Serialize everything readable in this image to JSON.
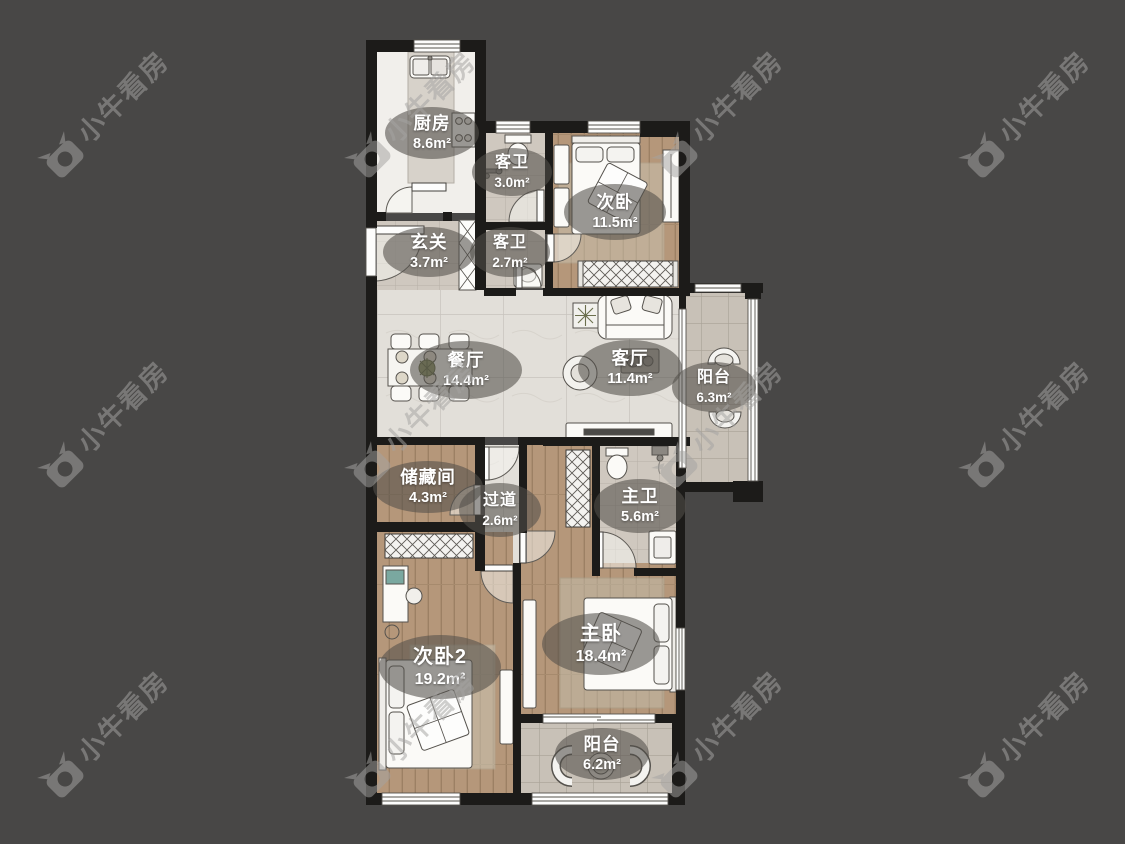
{
  "watermark": {
    "text": "小牛看房"
  },
  "rooms": [
    {
      "id": "kitchen",
      "name": "厨房",
      "area": "8.6m²"
    },
    {
      "id": "guest-bath-top",
      "name": "客卫",
      "area": "3.0m²"
    },
    {
      "id": "bedroom-second",
      "name": "次卧",
      "area": "11.5m²"
    },
    {
      "id": "entry",
      "name": "玄关",
      "area": "3.7m²"
    },
    {
      "id": "guest-bath",
      "name": "客卫",
      "area": "2.7m²"
    },
    {
      "id": "dining",
      "name": "餐厅",
      "area": "14.4m²"
    },
    {
      "id": "living",
      "name": "客厅",
      "area": "11.4m²"
    },
    {
      "id": "balcony-east",
      "name": "阳台",
      "area": "6.3m²"
    },
    {
      "id": "storage",
      "name": "储藏间",
      "area": "4.3m²"
    },
    {
      "id": "hallway",
      "name": "过道",
      "area": "2.6m²"
    },
    {
      "id": "master-bath",
      "name": "主卫",
      "area": "5.6m²"
    },
    {
      "id": "bedroom-second2",
      "name": "次卧2",
      "area": "19.2m²"
    },
    {
      "id": "master-bedroom",
      "name": "主卧",
      "area": "18.4m²"
    },
    {
      "id": "balcony-south",
      "name": "阳台",
      "area": "6.2m²"
    }
  ],
  "colors": {
    "background": "#484746",
    "wall": "#1c1b19",
    "wood_floor": "#b5977a",
    "tile_light": "#e3e0da",
    "tile_bath": "#cfc8bf",
    "tile_balcony": "#c9c2b8",
    "label_bubble": "rgba(82,79,74,0.58)",
    "watermark_gray": "#a5a4a2"
  }
}
